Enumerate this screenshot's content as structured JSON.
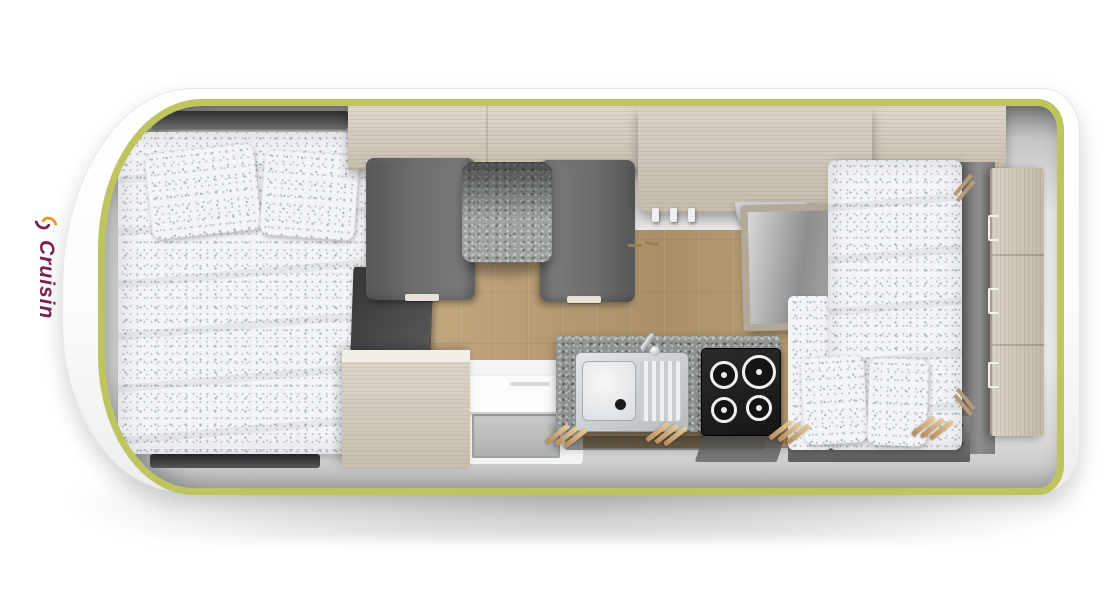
{
  "logo": {
    "brand": "Cruisin"
  },
  "palette": {
    "trim": "#bec45e",
    "body": "#fbfbfb",
    "wall": "#a6a6a6",
    "wood": "#d6cfc2",
    "floor": "#b79e77",
    "granite": "#8e9392",
    "seat": "#6e6e6e",
    "bedding": "#f3f4f6",
    "hob": "#1f1f1f",
    "steel": "#c9ced2",
    "logo_purple": "#7c2150",
    "logo_orange": "#f6921e"
  },
  "scene": {
    "type": "campervan-floorplan-top-view",
    "components": [
      "double-bed",
      "pillows",
      "skylight",
      "overhead-cabinets",
      "dinette-table",
      "dinette-benches",
      "entry-step",
      "side-cabinet",
      "kitchen-counter",
      "sink",
      "faucet",
      "gas-hob",
      "tall-cabinet",
      "open-shelf",
      "coat-hooks",
      "single-bed",
      "rear-drawer-cabinet",
      "window-slots",
      "wood-floor"
    ]
  }
}
